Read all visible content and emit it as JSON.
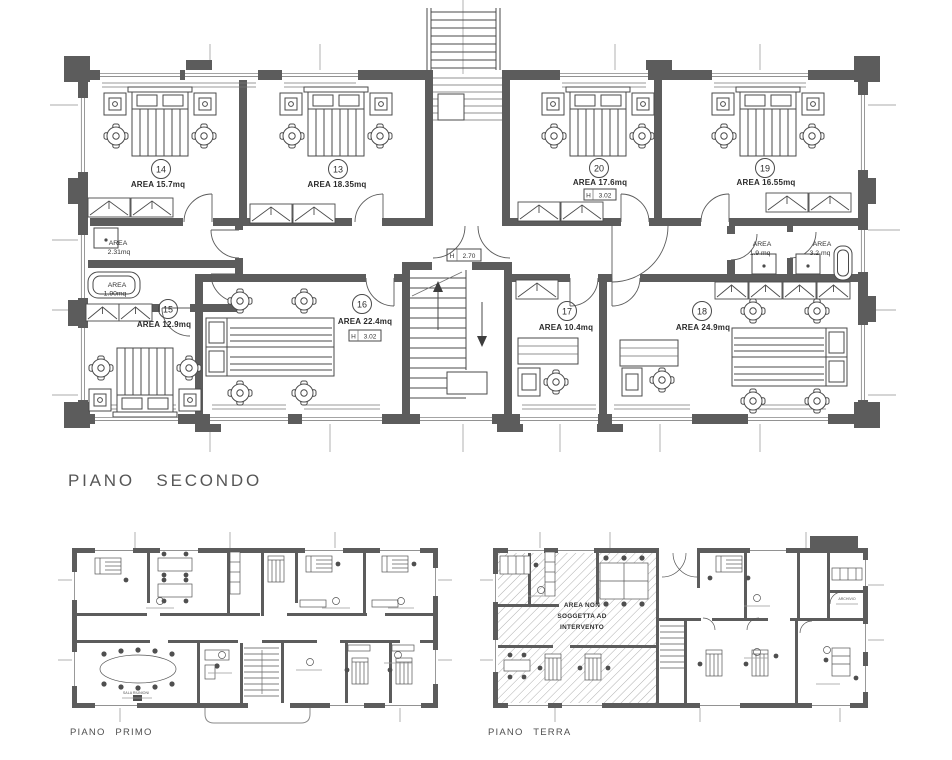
{
  "titles": {
    "secondo": "PIANO SECONDO",
    "primo": "PIANO PRIMO",
    "terra": "PIANO TERRA"
  },
  "secondo": {
    "rooms": [
      {
        "num": "14",
        "area": "AREA 15.7mq"
      },
      {
        "num": "13",
        "area": "AREA 18.35mq"
      },
      {
        "num": "20",
        "area": "AREA 17.6mq",
        "h_key": "H",
        "h_val": "3.02"
      },
      {
        "num": "19",
        "area": "AREA 16.55mq"
      },
      {
        "num": "15",
        "area": "AREA 12.9mq"
      },
      {
        "num": "16",
        "area": "AREA 22.4mq",
        "h_key": "H",
        "h_val": "3.02"
      },
      {
        "num": "17",
        "area": "AREA 10.4mq"
      },
      {
        "num": "18",
        "area": "AREA 24.9mq"
      }
    ],
    "service_areas": [
      {
        "line1": "AREA",
        "line2": "2.31mq"
      },
      {
        "line1": "AREA",
        "line2": "1.90mq"
      },
      {
        "line1": "AREA",
        "line2": "1.9 mq"
      },
      {
        "line1": "AREA",
        "line2": "3.2 mq"
      }
    ],
    "corridor_h": {
      "h_key": "H",
      "h_val": "2.70"
    }
  },
  "primo": {
    "sala_riunioni": "SALA RIUNIONI"
  },
  "terra": {
    "note": [
      "AREA NON",
      "SOGGETTA AD",
      "INTERVENTO"
    ],
    "archivio": "ARCHIVIO"
  },
  "colors": {
    "wall": "#5c5c5c",
    "line": "#4a4a4a",
    "hatch": "#9a9a9a",
    "text": "#2a2a2a",
    "title": "#565656",
    "background": "#ffffff"
  }
}
